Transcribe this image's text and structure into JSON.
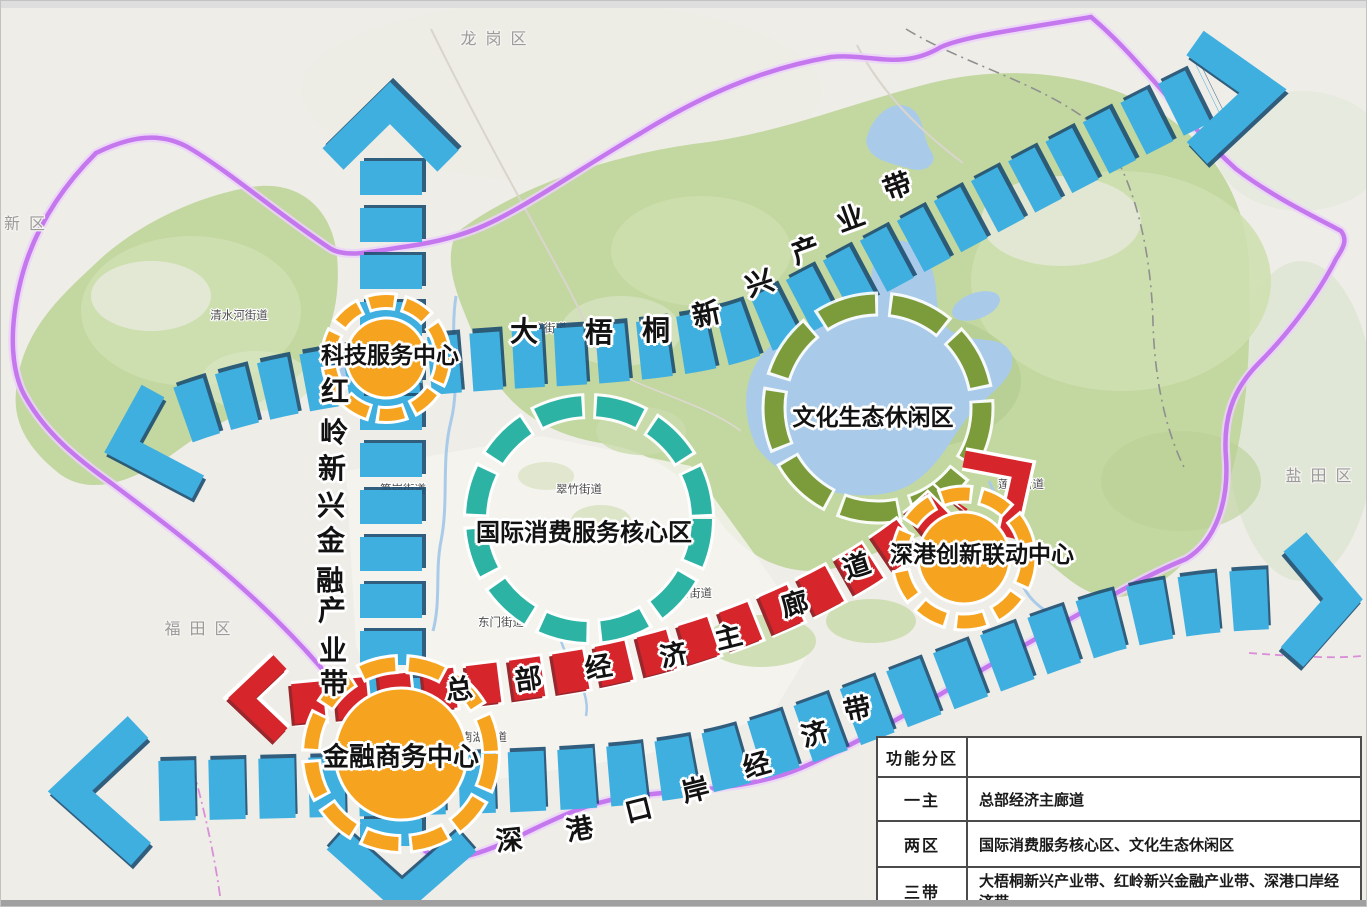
{
  "districts": {
    "longgang": "龙岗区",
    "yantian": "盐田区",
    "futian": "福田区",
    "xinqu": "新区"
  },
  "streets": {
    "qingshuihe": "清水河街道",
    "dongxiao": "东晓街道",
    "cuizhu": "翠竹街道",
    "sungang": "笋岗街道",
    "dongmen": "东门街道",
    "huangbei": "黄贝街道",
    "nanhu": "南湖街道",
    "liantang": "莲塘街道"
  },
  "belts": {
    "dawutong": {
      "name": "大梧桐新兴产业带"
    },
    "hongling": {
      "name": "红岭新兴金融产业带"
    },
    "gangkou": {
      "name": "深港口岸经济带"
    },
    "corridor": {
      "name": "总部经济主廊道"
    }
  },
  "zones": {
    "consumption": "国际消费服务核心区",
    "culture": "文化生态休闲区"
  },
  "centers": {
    "tech": "科技服务中心",
    "innovation": "深港创新联动中心",
    "finance": "金融商务中心"
  },
  "legend": {
    "header": "功能分区",
    "rows": [
      {
        "key": "一主",
        "value": "总部经济主廊道"
      },
      {
        "key": "两区",
        "value": "国际消费服务核心区、文化生态休闲区"
      },
      {
        "key": "三带",
        "value": "大梧桐新兴产业带、红岭新兴金融产业带、深港口岸经济带"
      }
    ]
  },
  "colors": {
    "belt_blue": "#3FAFE0",
    "belt_shadow": "#1C4E71",
    "corridor_red": "#D6252B",
    "corridor_shadow": "#8D1116",
    "center_orange": "#F6A41F",
    "zone_teal": "#2DB3A4",
    "zone_green": "#7C9C3C",
    "boundary_purple": "#C578EE",
    "water_blue": "#A9CBE9",
    "vegetation_green": "#C3D7A1"
  }
}
